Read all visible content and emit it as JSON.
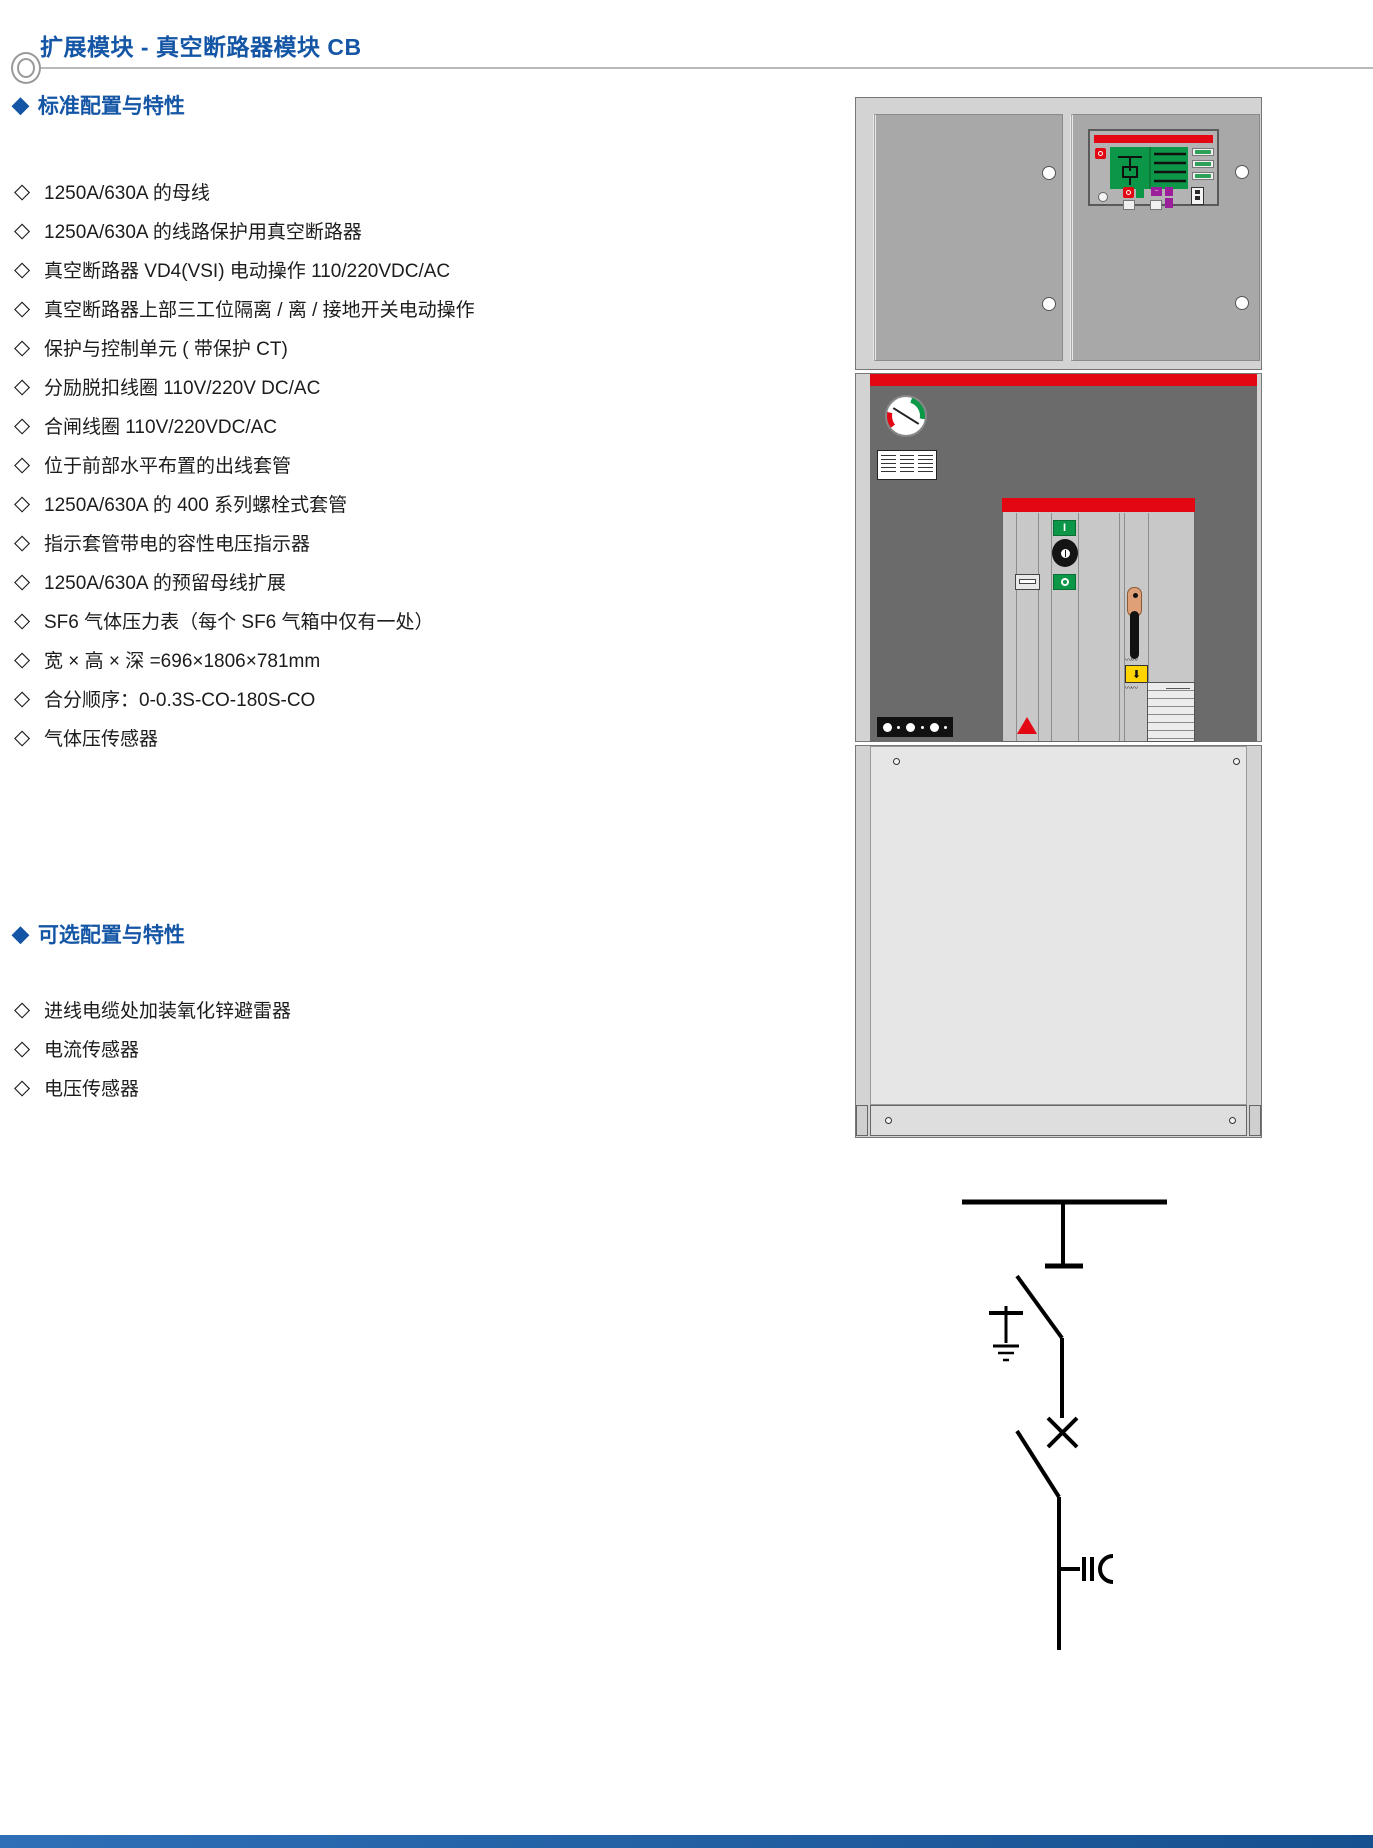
{
  "page": {
    "title": "扩展模块 - 真空断路器模块 CB"
  },
  "markers": {
    "heading": "◆",
    "item": "◇"
  },
  "sections": [
    {
      "heading": "标准配置与特性",
      "items": [
        "1250A/630A 的母线",
        "1250A/630A 的线路保护用真空断路器",
        "真空断路器 VD4(VSI) 电动操作 110/220VDC/AC",
        "真空断路器上部三工位隔离 / 离 / 接地开关电动操作",
        "保护与控制单元 ( 带保护 CT)",
        "分励脱扣线圈 110V/220V DC/AC",
        "合闸线圈 110V/220VDC/AC",
        "位于前部水平布置的出线套管",
        "1250A/630A 的 400 系列螺栓式套管",
        "指示套管带电的容性电压指示器",
        "1250A/630A 的预留母线扩展",
        "SF6 气体压力表（每个 SF6 气箱中仅有一处）",
        "宽 × 高 × 深 =696×1806×781mm",
        "合分顺序：0-0.3S-CO-180S-CO",
        "气体压传感器"
      ]
    },
    {
      "heading": "可选配置与特性",
      "items": [
        "进线电缆处加装氧化锌避雷器",
        "电流传感器",
        "电压传感器"
      ]
    }
  ],
  "figure": {
    "breaker": {
      "close_label": "I",
      "spring_arrow": "⬇"
    }
  },
  "colors": {
    "accent_blue": "#1456A5",
    "signal_red": "#E30613",
    "mimic_green": "#0C9648",
    "label_yellow": "#FFD400",
    "button_purple": "#9B1F9B"
  }
}
